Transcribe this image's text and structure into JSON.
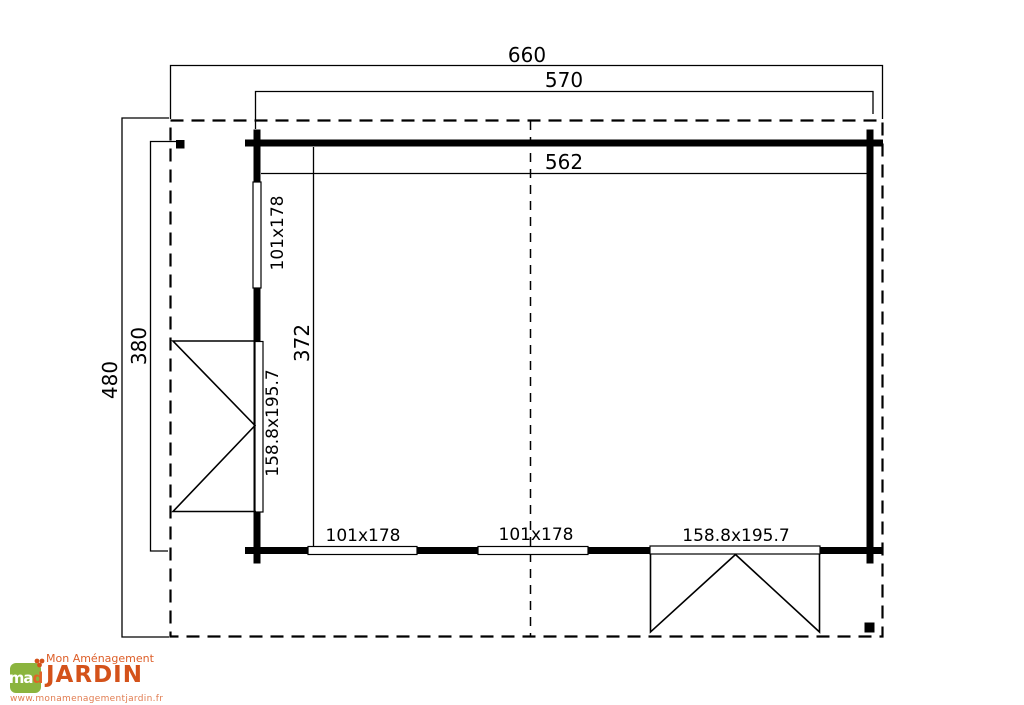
{
  "plan": {
    "overall_dimensions": {
      "roof_width": "660",
      "exterior_width": "570",
      "interior_width": "562",
      "roof_depth": "480",
      "exterior_depth": "380",
      "interior_depth": "372"
    },
    "openings": {
      "left_window_label": "101x178",
      "left_double_door_label": "158.8x195.7",
      "bottom_window_1_label": "101x178",
      "bottom_window_2_label": "101x178",
      "bottom_double_door_label": "158.8x195.7"
    }
  },
  "logo": {
    "monogram": "ma",
    "monogram_accent": "d",
    "brand_line1": "Mon Aménagement",
    "brand_line2": "JARDIN",
    "website": "www.monamenagementjardin.fr",
    "brand_orange": "#d4521a",
    "brand_green": "#8bb43e"
  }
}
